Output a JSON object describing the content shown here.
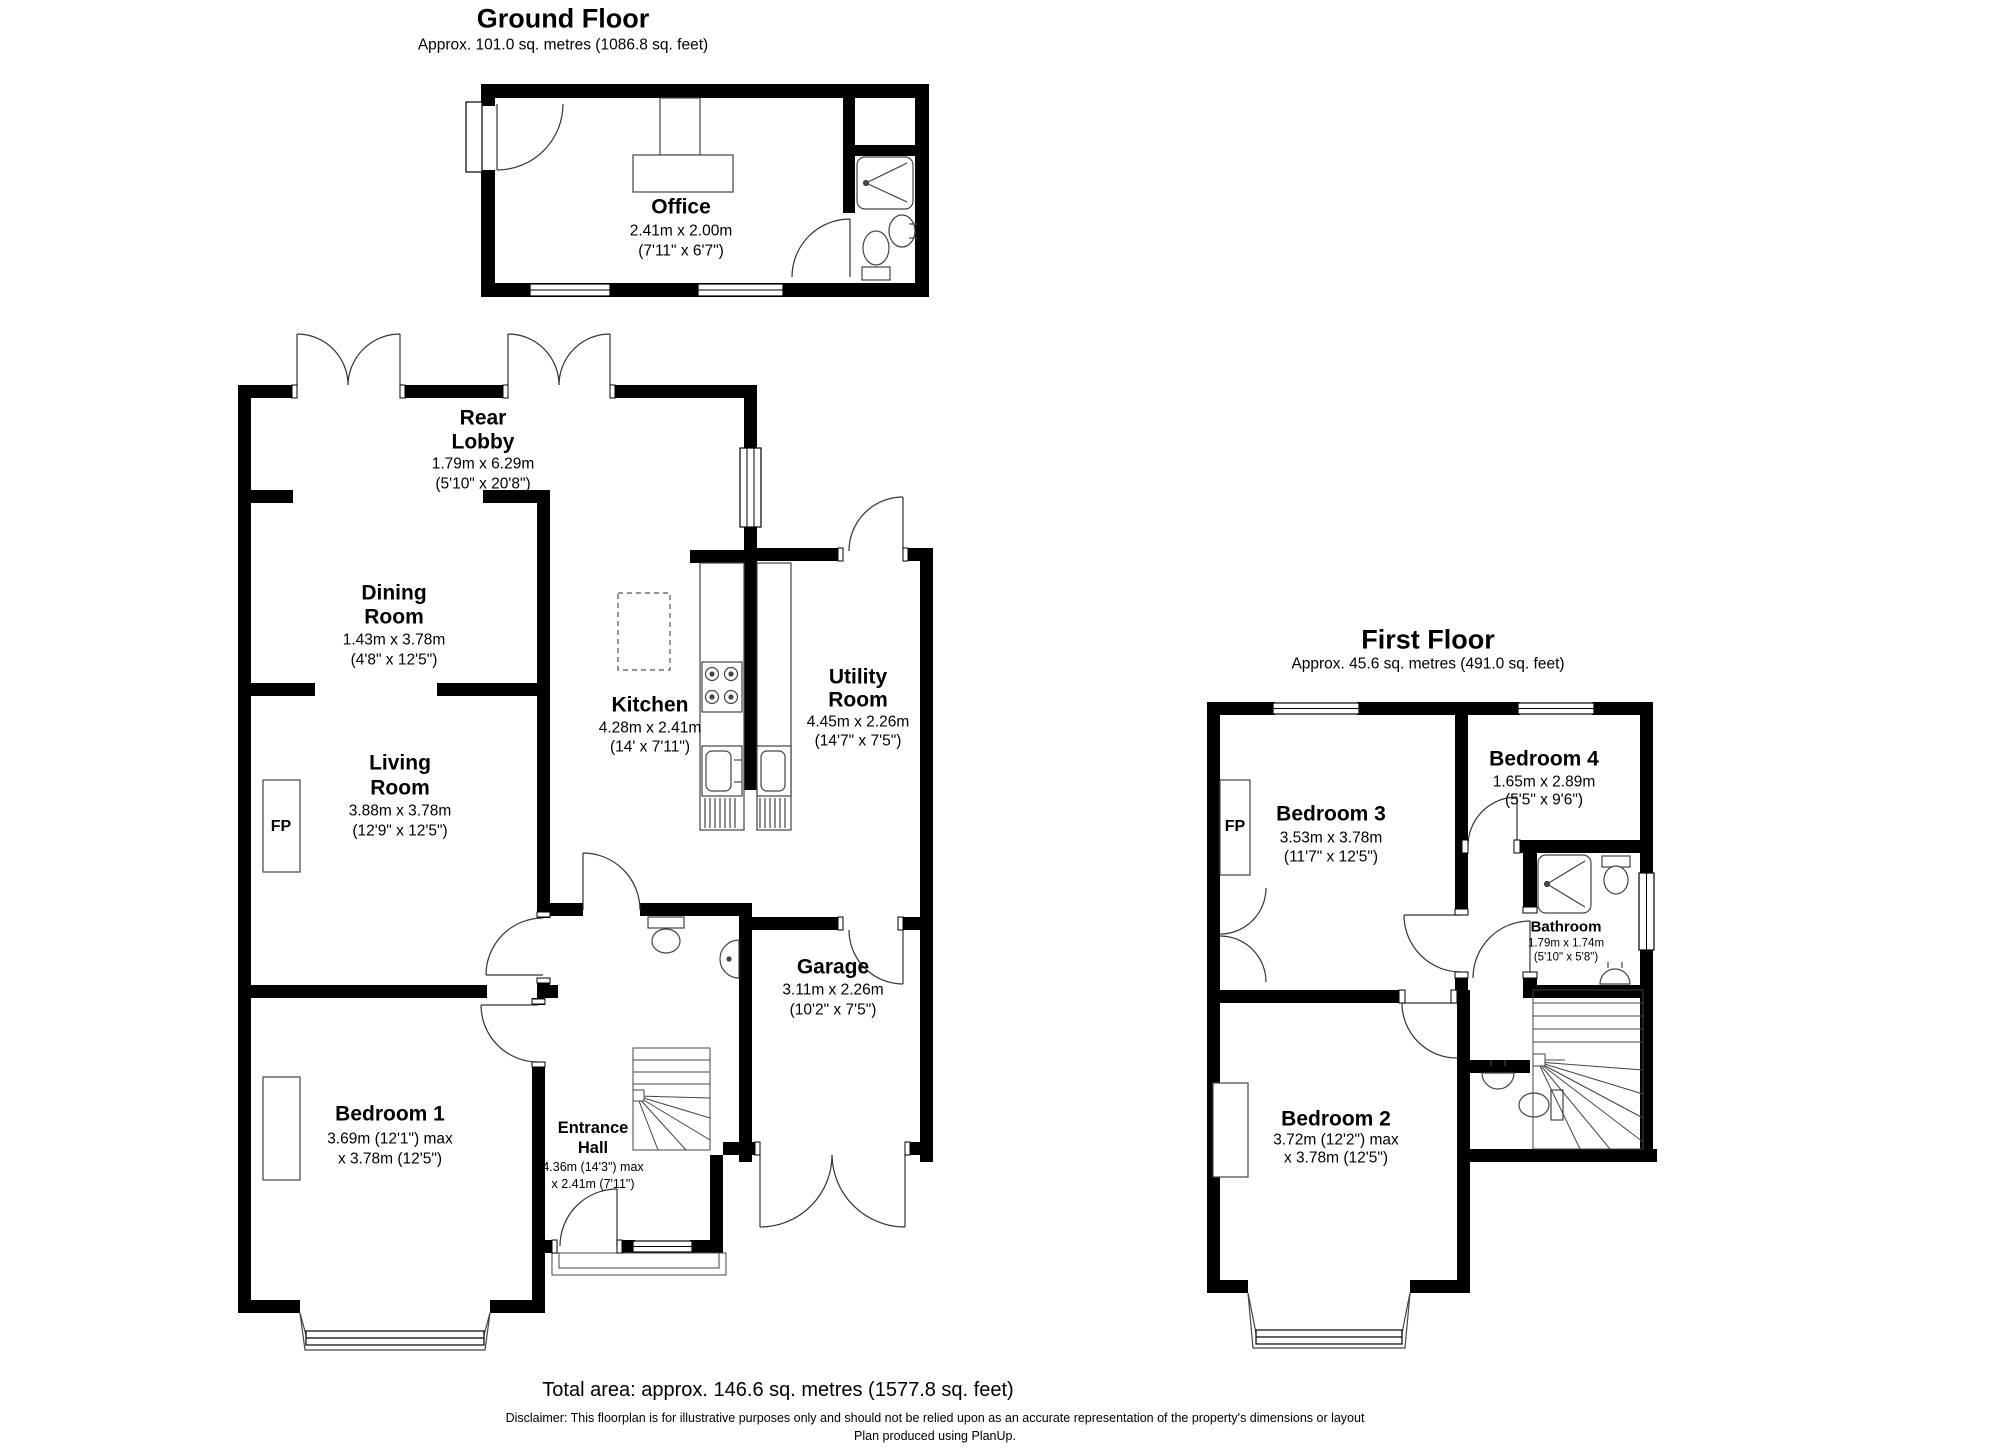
{
  "ground_floor": {
    "title": "Ground Floor",
    "area": "Approx. 101.0 sq. metres (1086.8 sq. feet)",
    "fireplace": "FP",
    "rooms": {
      "office": {
        "line1": "Office",
        "metric": "2.41m x 2.00m",
        "imperial": "(7'11\" x 6'7\")"
      },
      "rear_lobby": {
        "line1": "Rear",
        "line2": "Lobby",
        "metric": "1.79m x 6.29m",
        "imperial": "(5'10\" x 20'8\")"
      },
      "dining": {
        "line1": "Dining",
        "line2": "Room",
        "metric": "1.43m x 3.78m",
        "imperial": "(4'8\" x 12'5\")"
      },
      "living": {
        "line1": "Living",
        "line2": "Room",
        "metric": "3.88m x 3.78m",
        "imperial": "(12'9\" x 12'5\")"
      },
      "kitchen": {
        "line1": "Kitchen",
        "metric": "4.28m x 2.41m",
        "imperial": "(14' x 7'11\")"
      },
      "utility": {
        "line1": "Utility",
        "line2": "Room",
        "metric": "4.45m x 2.26m",
        "imperial": "(14'7\" x 7'5\")"
      },
      "garage": {
        "line1": "Garage",
        "metric": "3.11m x 2.26m",
        "imperial": "(10'2\" x 7'5\")"
      },
      "bedroom1": {
        "line1": "Bedroom 1",
        "metric": "3.69m (12'1\") max",
        "imperial": "x 3.78m (12'5\")"
      },
      "entrance": {
        "line1": "Entrance",
        "line2": "Hall",
        "metric": "4.36m (14'3\") max",
        "imperial": "x 2.41m (7'11\")"
      }
    }
  },
  "first_floor": {
    "title": "First Floor",
    "area": "Approx. 45.6 sq. metres (491.0 sq. feet)",
    "fireplace": "FP",
    "rooms": {
      "bedroom3": {
        "line1": "Bedroom 3",
        "metric": "3.53m x 3.78m",
        "imperial": "(11'7\" x 12'5\")"
      },
      "bedroom4": {
        "line1": "Bedroom 4",
        "metric": "1.65m x 2.89m",
        "imperial": "(5'5\" x 9'6\")"
      },
      "bathroom": {
        "line1": "Bathroom",
        "metric": "1.79m x 1.74m",
        "imperial": "(5'10\" x 5'8\")"
      },
      "bedroom2": {
        "line1": "Bedroom 2",
        "metric": "3.72m (12'2\") max",
        "imperial": "x 3.78m (12'5\")"
      }
    }
  },
  "footer": {
    "total_area": "Total area: approx. 146.6 sq. metres (1577.8 sq. feet)",
    "disclaimer": "Disclaimer: This floorplan is for illustrative purposes only and should not be relied upon as an accurate representation of the property's dimensions or layout",
    "produced_by": "Plan produced using PlanUp."
  },
  "colors": {
    "wall": "#000000",
    "line": "#333333",
    "background": "#ffffff"
  }
}
